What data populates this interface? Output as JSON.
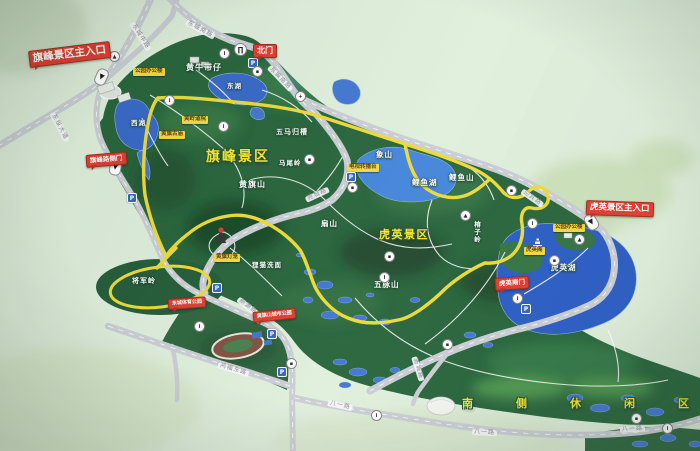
{
  "map": {
    "colors": {
      "board_background": "#dfeedb",
      "forest_green": "#1f5e34",
      "route_yellow": "#ecd930",
      "lake_blue": "#2f62c6",
      "entrance_red": "#dc3527",
      "facility_label_yellow": "#f2d837"
    },
    "region_titles": [
      {
        "t": "旗峰景区",
        "x": 206,
        "y": 150,
        "s": 14,
        "ls": 2
      },
      {
        "t": "虎英景区",
        "x": 379,
        "y": 229,
        "s": 11,
        "ls": 1.5
      },
      {
        "t": "南侧休闲区",
        "x": 462,
        "y": 398,
        "s": 11,
        "ls": 43
      }
    ],
    "gates": [
      {
        "t": "旗峰景区主入口",
        "x": 29,
        "y": 51,
        "r": -7,
        "s": 10.5
      },
      {
        "t": "北门",
        "x": 253,
        "y": 44,
        "r": 0,
        "s": 8
      },
      {
        "t": "虎英景区主入口",
        "x": 586,
        "y": 200,
        "r": 2,
        "s": 8.5
      },
      {
        "t": "旗峰路侧门",
        "x": 86,
        "y": 155,
        "r": -5,
        "s": 6.5
      },
      {
        "t": "虎英南门",
        "x": 495,
        "y": 278,
        "r": -4,
        "s": 6.5
      },
      {
        "t": "东城体育公园",
        "x": 168,
        "y": 299,
        "r": -4,
        "s": 5
      },
      {
        "t": "黄旗山城市公园",
        "x": 253,
        "y": 312,
        "r": -6,
        "s": 5
      }
    ],
    "road_labels": [
      {
        "t": "东城中路",
        "x": 132,
        "y": 20,
        "r": 58
      },
      {
        "t": "东纵大道",
        "x": 52,
        "y": 110,
        "r": 62
      },
      {
        "t": "东城南路",
        "x": 186,
        "y": 19,
        "r": 28
      },
      {
        "t": "东城南路",
        "x": 269,
        "y": 64,
        "r": 46
      },
      {
        "t": "迎宾路",
        "x": 522,
        "y": 188,
        "r": 35
      },
      {
        "t": "莞城路",
        "x": 306,
        "y": 197,
        "r": -25
      },
      {
        "t": "新源路",
        "x": 238,
        "y": 296,
        "r": 38
      },
      {
        "t": "新城路",
        "x": 414,
        "y": 354,
        "r": 72
      },
      {
        "t": "鸿福东路",
        "x": 218,
        "y": 362,
        "r": 17
      },
      {
        "t": "八一路",
        "x": 328,
        "y": 400,
        "r": 12
      },
      {
        "t": "八一路",
        "x": 472,
        "y": 429,
        "r": 3
      },
      {
        "t": "八一路",
        "x": 620,
        "y": 427,
        "r": -3
      }
    ],
    "terrain_labels": [
      {
        "t": "黄牛带仔",
        "x": 186,
        "y": 64,
        "s": 8
      },
      {
        "t": "五马归槽",
        "x": 276,
        "y": 129,
        "s": 7
      },
      {
        "t": "马尾岭",
        "x": 279,
        "y": 160,
        "s": 6.5
      },
      {
        "t": "黄旗山",
        "x": 239,
        "y": 181,
        "s": 8
      },
      {
        "t": "西湖",
        "x": 131,
        "y": 120,
        "s": 6.5
      },
      {
        "t": "东湖",
        "x": 227,
        "y": 83,
        "s": 6.5
      },
      {
        "t": "象山",
        "x": 376,
        "y": 151,
        "s": 7.5
      },
      {
        "t": "扇山",
        "x": 321,
        "y": 220,
        "s": 7.5
      },
      {
        "t": "鲤鱼山",
        "x": 449,
        "y": 174,
        "s": 7.5
      },
      {
        "t": "鲤鱼湖",
        "x": 412,
        "y": 179,
        "s": 7.5
      },
      {
        "t": "榕子岭",
        "x": 473,
        "y": 221,
        "s": 6.5,
        "vert": true
      },
      {
        "t": "五脉山",
        "x": 374,
        "y": 281,
        "s": 7.5
      },
      {
        "t": "狸猫洗面",
        "x": 252,
        "y": 262,
        "s": 6.5
      },
      {
        "t": "将军岭",
        "x": 132,
        "y": 278,
        "s": 7
      },
      {
        "t": "虎英湖",
        "x": 551,
        "y": 264,
        "s": 7.5
      }
    ],
    "facility_labels": [
      {
        "t": "公园办公楼",
        "x": 133,
        "y": 68
      },
      {
        "t": "黄岭道院",
        "x": 182,
        "y": 116
      },
      {
        "t": "黄旗古庙",
        "x": 159,
        "y": 131
      },
      {
        "t": "电视转播台",
        "x": 347,
        "y": 164
      },
      {
        "t": "黄旗灯笼",
        "x": 214,
        "y": 254
      },
      {
        "t": "虎英阁",
        "x": 524,
        "y": 247
      },
      {
        "t": "公园办公楼",
        "x": 553,
        "y": 224
      }
    ],
    "icons": [
      {
        "k": "gate",
        "x": 234,
        "y": 43,
        "g": "∏"
      },
      {
        "k": "arrow",
        "x": 93,
        "y": 71,
        "r": 115,
        "g": "▶"
      },
      {
        "k": "arrow",
        "x": 107,
        "y": 161,
        "r": 100,
        "g": "▶"
      },
      {
        "k": "arrow",
        "x": 583,
        "y": 216,
        "r": 60,
        "g": "▶"
      },
      {
        "k": "park",
        "x": 248,
        "y": 58,
        "g": "P"
      },
      {
        "k": "park",
        "x": 346,
        "y": 172,
        "g": "P"
      },
      {
        "k": "park",
        "x": 212,
        "y": 283,
        "g": "P"
      },
      {
        "k": "park",
        "x": 267,
        "y": 329,
        "g": "P"
      },
      {
        "k": "park",
        "x": 277,
        "y": 367,
        "g": "P"
      },
      {
        "k": "park",
        "x": 521,
        "y": 304,
        "g": "P"
      },
      {
        "k": "park",
        "x": 127,
        "y": 193,
        "g": "P"
      },
      {
        "k": "poi",
        "x": 219,
        "y": 48,
        "g": "i"
      },
      {
        "k": "poi",
        "x": 252,
        "y": 66,
        "g": "▪"
      },
      {
        "k": "poi",
        "x": 295,
        "y": 91,
        "g": "+"
      },
      {
        "k": "poi",
        "x": 164,
        "y": 95,
        "g": "i"
      },
      {
        "k": "poi",
        "x": 109,
        "y": 51,
        "g": "▲"
      },
      {
        "k": "poi",
        "x": 218,
        "y": 121,
        "g": "i"
      },
      {
        "k": "poi",
        "x": 347,
        "y": 182,
        "g": "▪"
      },
      {
        "k": "poi",
        "x": 384,
        "y": 251,
        "g": "▪"
      },
      {
        "k": "poi",
        "x": 379,
        "y": 272,
        "g": "i"
      },
      {
        "k": "poi",
        "x": 460,
        "y": 210,
        "g": "▲"
      },
      {
        "k": "poi",
        "x": 506,
        "y": 185,
        "g": "▪"
      },
      {
        "k": "poi",
        "x": 527,
        "y": 218,
        "g": "i"
      },
      {
        "k": "poi",
        "x": 574,
        "y": 234,
        "g": "▲"
      },
      {
        "k": "poi",
        "x": 549,
        "y": 255,
        "g": "▪"
      },
      {
        "k": "poi",
        "x": 512,
        "y": 293,
        "g": "i"
      },
      {
        "k": "poi",
        "x": 442,
        "y": 339,
        "g": "▪"
      },
      {
        "k": "poi",
        "x": 371,
        "y": 410,
        "g": "i"
      },
      {
        "k": "poi",
        "x": 631,
        "y": 413,
        "g": "▪"
      },
      {
        "k": "poi",
        "x": 662,
        "y": 423,
        "g": "i"
      },
      {
        "k": "poi",
        "x": 286,
        "y": 358,
        "g": "▪"
      },
      {
        "k": "poi",
        "x": 194,
        "y": 321,
        "g": "i"
      },
      {
        "k": "poi",
        "x": 304,
        "y": 154,
        "g": "▪"
      }
    ]
  }
}
